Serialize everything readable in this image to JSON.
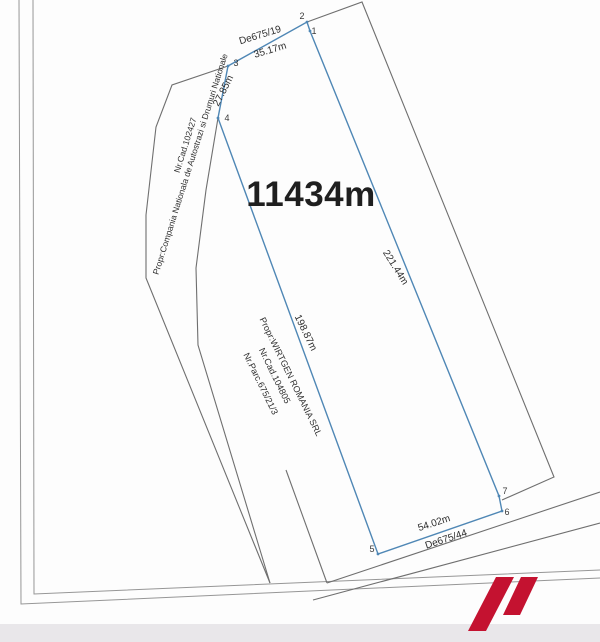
{
  "plan": {
    "area_label": "11434m",
    "owner_parcel": {
      "owner": "Propr:WIRTGEN ROMANIA SRL",
      "cadastral_no": "Nr.Cad.104805",
      "parcel_no": "Nr.Parc.675/21/3"
    },
    "neighbor_parcel": {
      "owner": "Propr:Compania Nationala de Autostrazi si Drumuri Nationale",
      "cadastral_no": "Nr.Cad.102427"
    },
    "roads": {
      "top_road": "De675/19",
      "bottom_road": "De675/44"
    },
    "dimensions": {
      "top": "35.17m",
      "upper_left": "27.85m",
      "right": "221.44m",
      "left": "198.87m",
      "bottom": "54.02m"
    },
    "points": {
      "p1": "1",
      "p2": "2",
      "p3": "3",
      "p4": "4",
      "p5": "5",
      "p6": "6",
      "p7": "7"
    }
  },
  "colors": {
    "parcel_outline": "#4f87b5",
    "boundary": "#6f6f6f",
    "frame": "#969696",
    "logo_red": "#c41230",
    "footer_band": "#e9e7ea"
  }
}
